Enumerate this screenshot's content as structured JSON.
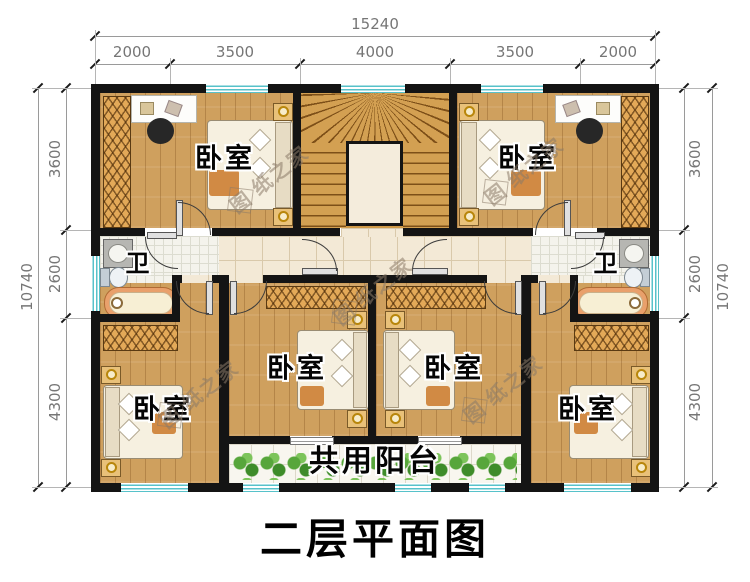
{
  "title": {
    "text": "二层平面图"
  },
  "watermark": {
    "first": "图",
    "rest": "纸之家"
  },
  "dimensions": {
    "top": {
      "total": "15240",
      "segments": [
        "2000",
        "3500",
        "4000",
        "3500",
        "2000"
      ]
    },
    "left": {
      "total": "10740",
      "segments": [
        "3600",
        "2600",
        "4300"
      ]
    },
    "right": {
      "total": "10740",
      "segments": [
        "3600",
        "2600",
        "4300"
      ]
    }
  },
  "rooms": {
    "bedroom_top_left": {
      "label": "卧室"
    },
    "bedroom_top_right": {
      "label": "卧室"
    },
    "bedroom_mid_left": {
      "label": "卧室"
    },
    "bedroom_mid_right": {
      "label": "卧室"
    },
    "bedroom_bottom_left": {
      "label": "卧室"
    },
    "bedroom_bottom_right": {
      "label": "卧室"
    },
    "bathroom_left": {
      "label": "卫"
    },
    "bathroom_right": {
      "label": "卫"
    },
    "balcony": {
      "label": "共用阳台"
    }
  },
  "colors": {
    "wall": "#141414",
    "wood_floor": "#cfa05e",
    "tile_floor": "#f3e9d6",
    "stair_wood": "#cf9a49",
    "window_glass": "#57c2ca",
    "plant_green": "#57a63b",
    "tub_rim": "#e9a06b"
  }
}
